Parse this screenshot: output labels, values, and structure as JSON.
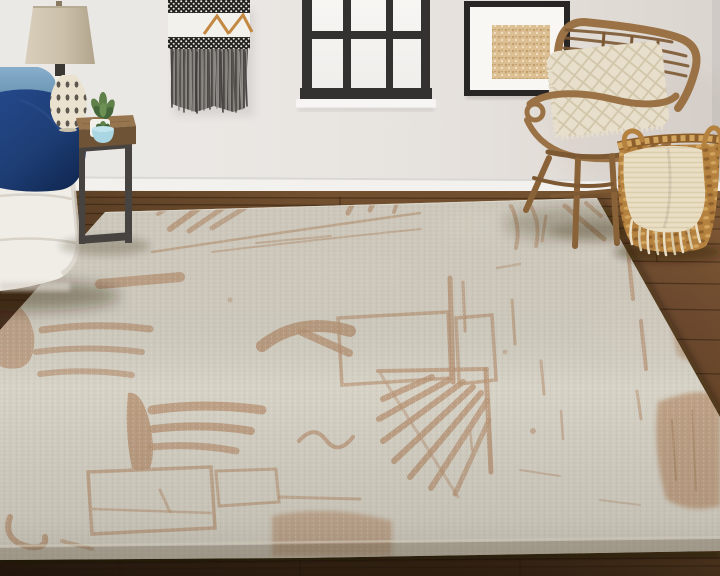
{
  "meta": {
    "width": 720,
    "height": 576,
    "scene": "living-room corner with abstract beige area rug, white sofa, rattan chair, basket and window"
  },
  "objects": [
    "wall",
    "window",
    "wall-hanging",
    "framed-art",
    "baseboard",
    "wood-floor",
    "area-rug",
    "sofa",
    "light-blue-pillow",
    "navy-pillow",
    "table-lamp",
    "side-table",
    "potted-plant",
    "blue-bowl",
    "rattan-chair",
    "chair-pillow",
    "woven-basket",
    "throw-blanket"
  ],
  "colors": {
    "wall": "#eae7e3",
    "wall_right": "#ddd7d2",
    "baseboard": "#f2f1ee",
    "floor_top": "#6e4c2e",
    "floor_mid": "#5f3f25",
    "floor_deep": "#46301c",
    "floor_bottom": "#2c1d10",
    "rug_field": "#d6d2c6",
    "rug_light": "#ddd8cb",
    "rug_edge_band": "#b0a890",
    "rug_motif": "#b99677",
    "rug_motif_dark": "#a07c58",
    "sofa": "#f0ede7",
    "sofa_shadow": "#d8d2c9",
    "pillow_blue": "#7ba3c2",
    "pillow_blue_dark": "#5d88a9",
    "pillow_navy": "#1d3d74",
    "pillow_navy_dark": "#142c58",
    "lamp_shade": "#cdc2ae",
    "lamp_base": "#eae2cf",
    "lamp_neck": "#3b3733",
    "lamp_dot": "#4e4742",
    "table_top": "#97754e",
    "table_front": "#6e5336",
    "table_metal": "#474341",
    "plant_green": "#5f8049",
    "plant_dark": "#44663a",
    "pot_white": "#f2f0ea",
    "bowl_blue": "#a9d6e2",
    "hanging_dark": "#23221f",
    "hanging_white": "#f3f1ec",
    "hanging_accent": "#c08238",
    "fringe_gray": "#6e6c6a",
    "window_frame": "#343230",
    "window_pane": "#f3f2ef",
    "window_sill": "#f6f5f3",
    "art_frame": "#282624",
    "art_mat": "#f8f7f4",
    "art_fill": "#dcc094",
    "rattan": "#9a7245",
    "rattan_dark": "#7c5833",
    "rattan_light": "#b08a55",
    "chair_pillow": "#e7dfcb",
    "chair_pillow_line": "#cfc3a6",
    "basket": "#b5813f",
    "basket_dark": "#8c5e2b",
    "basket_light": "#d2a55e",
    "throw": "#eadfc5",
    "throw_line": "#d9cba9",
    "shadow": "rgba(38,26,14,0.38)"
  }
}
